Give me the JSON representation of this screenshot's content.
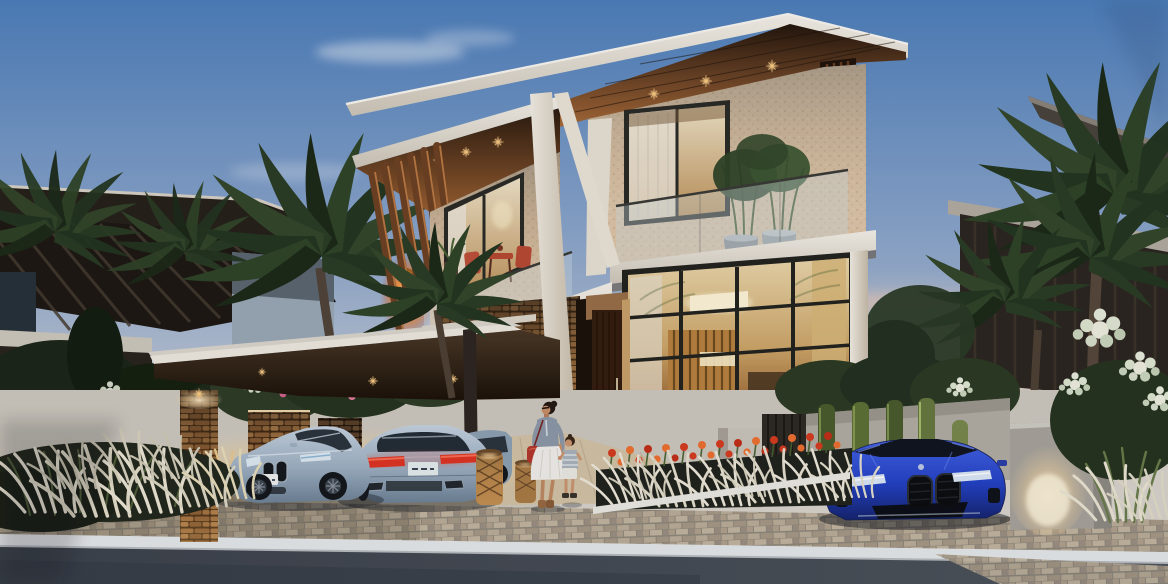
{
  "meta": {
    "type": "architectural-rendering",
    "description": "Photorealistic dusk exterior rendering of a modern three-storey luxury villa with angular white roof blades, warm-lit wood soffits, stacked-stone walls, a glass curtain wall, a cantilevered carport sheltering silver coupes, a blue sports coupe by the gate, palm trees, tulip flower beds, and a woman walking hand-in-hand with a child toward the street.",
    "time_of_day": "dusk",
    "visible_text": "none (license plates present but illegible)"
  },
  "palette": {
    "sky_top": "#4d7fbc",
    "sky_mid": "#93abcd",
    "sky_low": "#cfd2d8",
    "sky_horizon": "#ecd9c2",
    "horizon_pink": "#f0cfae",
    "cloud": "#e8eef6",
    "roof_white": "#f0ebe1",
    "roof_shadow": "#cfc7b9",
    "soffit_dark": "#2a1c10",
    "soffit_warm": "#8a5a2e",
    "fin_wood": "#6e4122",
    "fin_highlight": "#c98448",
    "ember_glow": "#ff9030",
    "ember_core": "#ffdf9a",
    "stone_joint": "#1a1109",
    "stone_face": "#8a6742",
    "villa_stone": "#d8cbb6",
    "glass_warm_top": "#ecd8ab",
    "glass_warm_deep": "#a06a34",
    "interior_light": "#fff3cf",
    "mullion": "#22221e",
    "balustrade_glass": "#cfdde2",
    "canopy_fascia": "#efeae1",
    "canopy_under": "#241a10",
    "light_warm": "#ffd9a0",
    "car_silver_hi": "#c6d3e0",
    "car_silver": "#9db0c2",
    "car_silver_dark": "#6e8296",
    "car_glass": "#29323b",
    "taillight_red": "#e03424",
    "plate_white": "#eef0ee",
    "car_blue_hi": "#4463e8",
    "car_blue": "#2341c4",
    "car_blue_dark": "#15246e",
    "road_asphalt": "#434952",
    "curb_white": "#e6e9ea",
    "paver_tan": "#bcae98",
    "sidewalk": "#d9d5cd",
    "driveway_warm": "#d3c3a6",
    "palm_dark": "#243620",
    "palm_light": "#33482a",
    "shrub_dark": "#1c2618",
    "hedge_green": "#55672f",
    "grass_plume": "#ece6d4",
    "tulip_red": "#d63b1e",
    "tulip_orange": "#ef7030",
    "wicker": "#b98a4f",
    "skin": "#c9906a",
    "hair_dark": "#241812",
    "woman_shirt": "#8d9aa8",
    "woman_skirt": "#f2f0ea",
    "bag_red": "#b5372b",
    "boots_tan": "#9a6a42"
  },
  "scene": {
    "villa": {
      "storeys": 3,
      "features": [
        "angular white roof blades",
        "wood plank soffits with recessed star lights",
        "stacked stone feature walls",
        "speckled stone facade",
        "glass balustrade balconies",
        "bamboo planter pots",
        "red bistro terrace set",
        "ground floor glass curtain wall",
        "timber entry door",
        "ember-lit timber fin screen",
        "white structural mast and braces"
      ]
    },
    "carport": {
      "type": "cantilevered flat canopy",
      "downlights": 2,
      "stone_piers": 3
    },
    "vehicles": [
      {
        "name": "silver-blue coupe",
        "view": "front three-quarter",
        "position": "carport left",
        "plate": "illegible"
      },
      {
        "name": "silver-blue coupe",
        "view": "rear",
        "position": "carport centre",
        "plate": "illegible"
      },
      {
        "name": "silver coupe",
        "view": "partial side",
        "position": "behind canopy post"
      },
      {
        "name": "blue sports coupe",
        "view": "front",
        "position": "right gate driveway"
      }
    ],
    "figures": [
      {
        "name": "woman",
        "details": "dark bun, sunglasses, chambray shirt, white skirt, red shoulder bag, tan boots"
      },
      {
        "name": "child",
        "details": "striped top, white shorts, holding the woman's hand"
      }
    ],
    "landscape": {
      "flower_bed": "red-orange tulips over white feather grass",
      "left_garden": "white plume ornamental grasses and dark shrubs",
      "mid_garden": "white and pink flowering shrubs between stone piers",
      "right_wall": "clipped hedge panels on concrete wall with uplight",
      "right_flowers": "white hydrangea masses",
      "palms": 8
    },
    "street": {
      "surfaces": [
        "asphalt road",
        "white curb",
        "brick paver band",
        "concrete sidewalk",
        "timber-look driveway apron"
      ]
    },
    "neighbors": {
      "left": "dark villa with diagonal louver roof screen",
      "right": "dark villa with slatted facade behind palms"
    }
  }
}
